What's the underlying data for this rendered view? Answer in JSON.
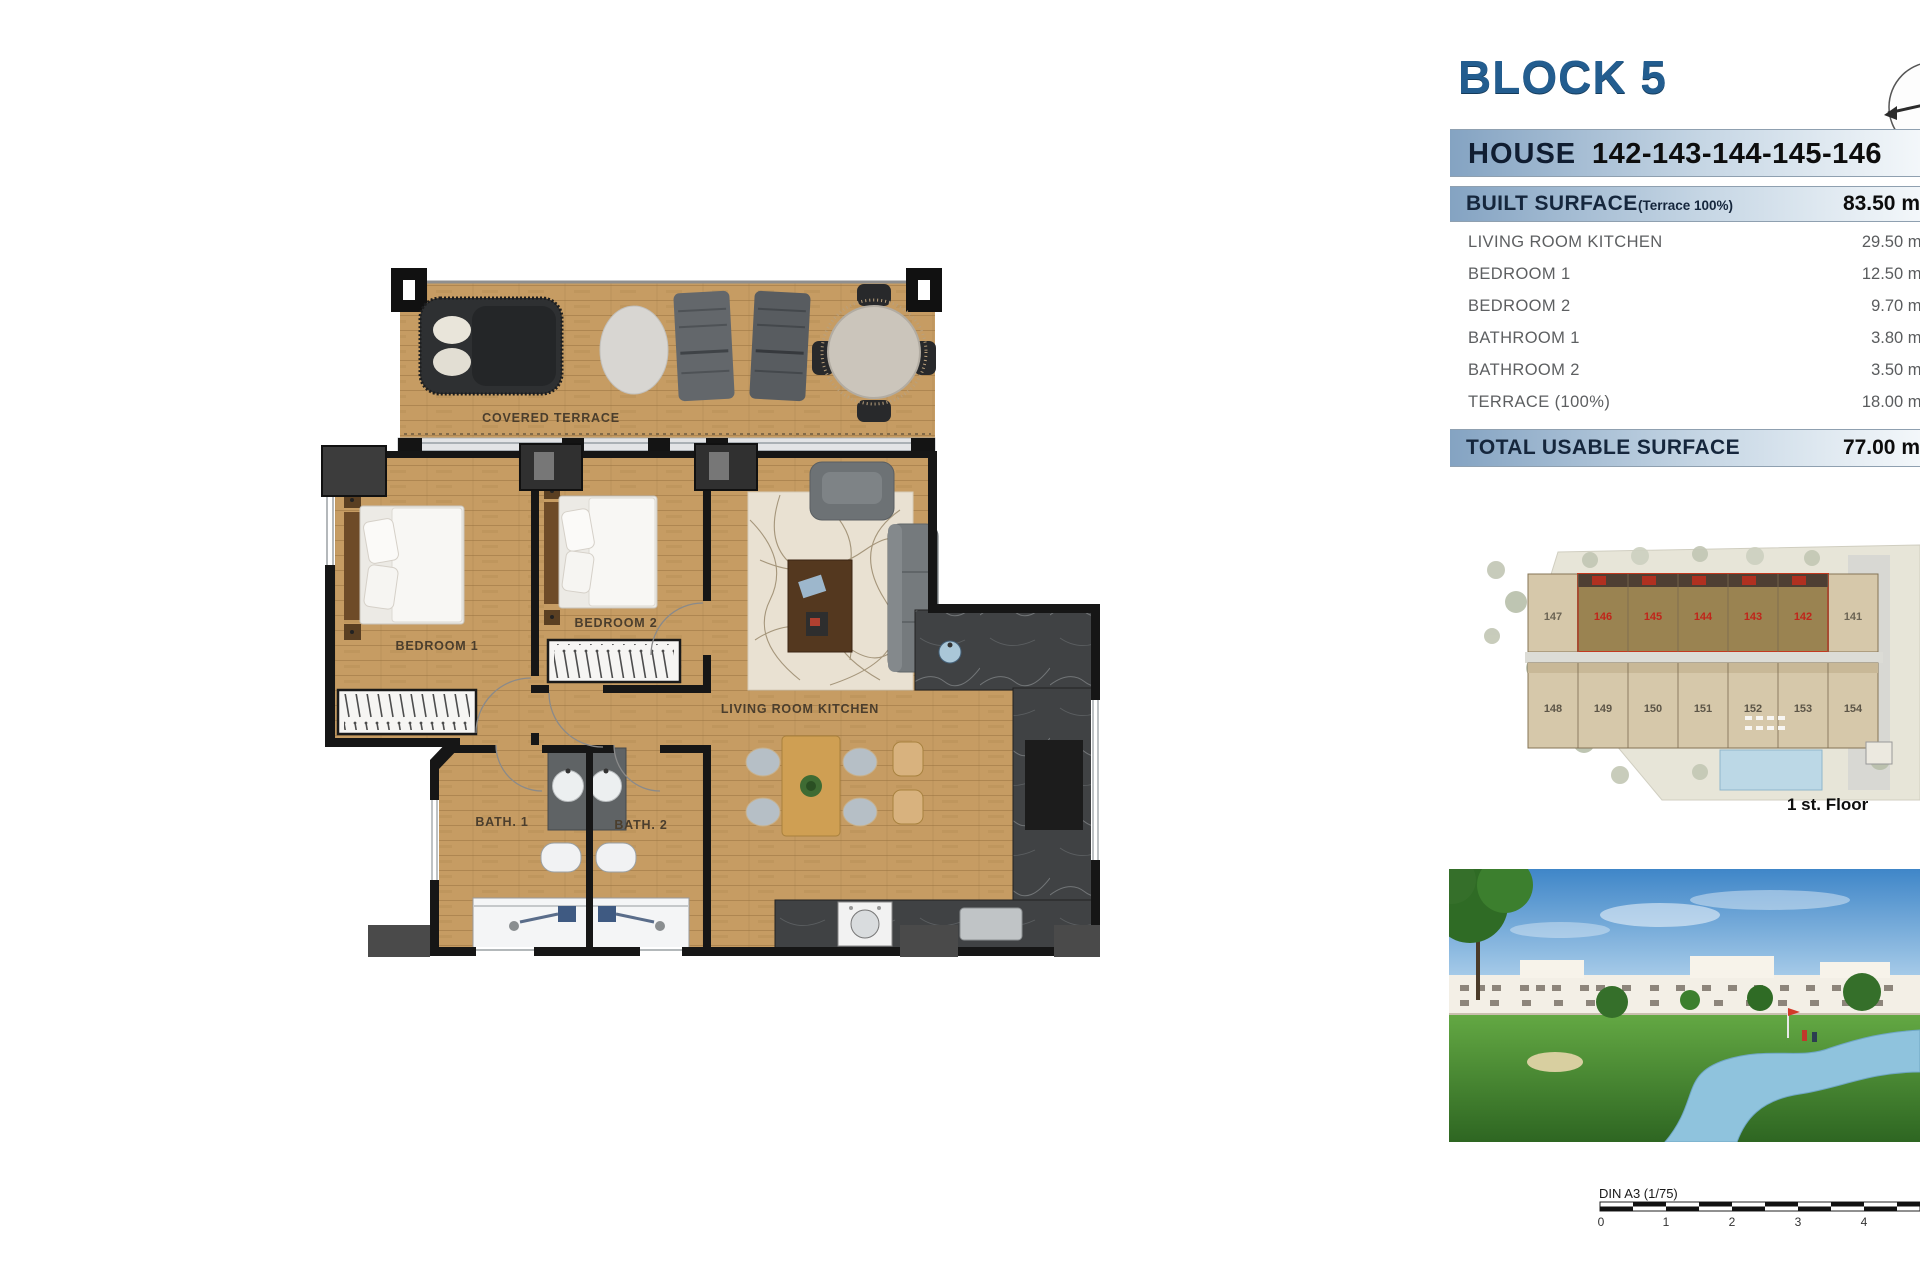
{
  "header": {
    "block_title": "BLOCK 5"
  },
  "house_bar": {
    "label": "HOUSE",
    "numbers": "142-143-144-145-146"
  },
  "surface_table": {
    "built_surface": {
      "label": "BUILT SURFACE",
      "note": "(Terrace 100%)",
      "value": "83.50 m²"
    },
    "rows": [
      {
        "label": "LIVING ROOM KITCHEN",
        "value": "29.50 m²"
      },
      {
        "label": "BEDROOM 1",
        "value": "12.50 m²"
      },
      {
        "label": "BEDROOM 2",
        "value": "9.70 m²"
      },
      {
        "label": "BATHROOM 1",
        "value": "3.80 m²"
      },
      {
        "label": "BATHROOM 2",
        "value": "3.50 m²"
      },
      {
        "label": "TERRACE (100%)",
        "value": "18.00 m²"
      }
    ],
    "total": {
      "label": "TOTAL USABLE SURFACE",
      "value": "77.00 m²"
    }
  },
  "floor_plan": {
    "labels": {
      "terrace": "COVERED TERRACE",
      "bedroom1": "BEDROOM 1",
      "bedroom2": "BEDROOM 2",
      "living": "LIVING ROOM KITCHEN",
      "bath1": "BATH. 1",
      "bath2": "BATH. 2"
    }
  },
  "site_plan": {
    "caption": "1 st. Floor",
    "top_units": [
      "147",
      "146",
      "145",
      "144",
      "143",
      "142",
      "141"
    ],
    "bottom_units": [
      "148",
      "149",
      "150",
      "151",
      "152",
      "153",
      "154"
    ],
    "highlighted_units": [
      "146",
      "145",
      "144",
      "143",
      "142"
    ],
    "highlight_color": "#c3391f"
  },
  "scale_bar": {
    "label": "DIN A3 (1/75)",
    "ticks": [
      "0",
      "1",
      "2",
      "3",
      "4"
    ]
  },
  "colors": {
    "title_blue": "#235d8f",
    "bar_gradient_start": "#84a3c2",
    "bar_text_navy": "#15263c",
    "row_text_gray": "#5d5f61",
    "wood": "#c69c63",
    "highlight_red": "#c3391f",
    "pool_blue": "#bcd8e6"
  }
}
